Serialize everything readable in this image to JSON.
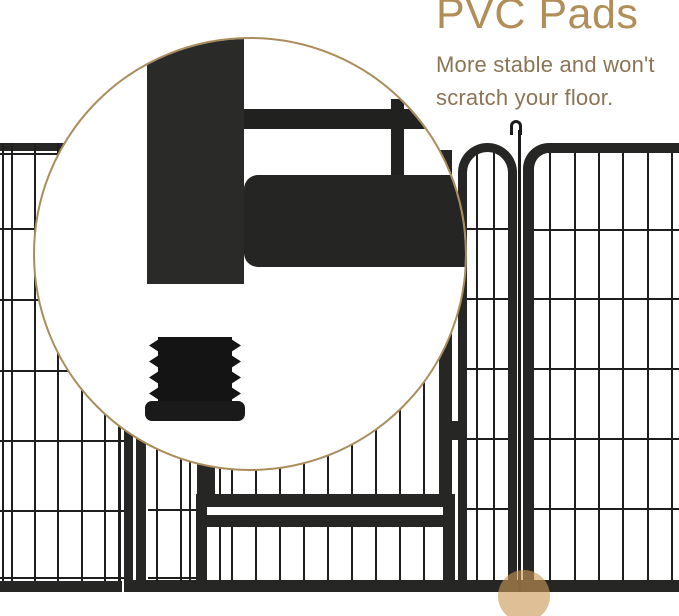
{
  "annotation": {
    "heading": "PVC Pads",
    "subtitle_line1": "More stable and won't",
    "subtitle_line2": "scratch your floor."
  },
  "colors": {
    "heading_tan": "#b18d58",
    "subtitle_brown": "#8c7454",
    "magnifier_ring_tan": "#ab8d5c",
    "fence_black": "#262624",
    "wire_black": "#1e1e1e",
    "highlight_marker_tan": "#cb9855"
  },
  "icons": {
    "magnifier": "magnifier-circle",
    "pad": "pvc-pad-icon",
    "marker": "foot-highlight-marker",
    "hook": "hinge-hook-icon"
  }
}
